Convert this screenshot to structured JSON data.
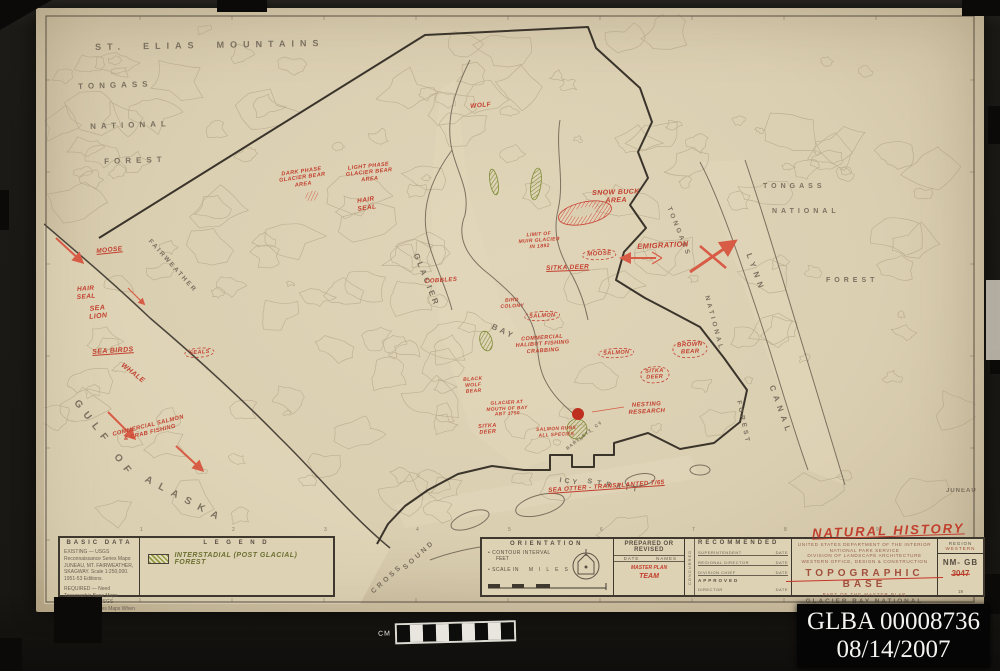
{
  "archive_label": {
    "line1": "GLBA 00008736",
    "line2": "08/14/2007"
  },
  "ruler_label": "CM",
  "natural_history_note": "NATURAL HISTORY",
  "colors": {
    "annotation_red": "#c2402f",
    "forest_green": "#8f9c3e",
    "sheet_beige": "#dbcfb2",
    "ink_brown": "#4a443a"
  },
  "map": {
    "grid_numbers": [
      "1",
      "2",
      "3",
      "4",
      "5",
      "6",
      "7",
      "8",
      "9"
    ],
    "place_labels": [
      {
        "t": "ST.  ELIAS  MOUNTAINS",
        "x": 95,
        "y": 42,
        "s": 9,
        "ls": 6,
        "r": -1
      },
      {
        "t": "TONGASS",
        "x": 78,
        "y": 82,
        "s": 8,
        "ls": 5,
        "r": -2
      },
      {
        "t": "NATIONAL",
        "x": 90,
        "y": 122,
        "s": 8,
        "ls": 5,
        "r": -2
      },
      {
        "t": "FOREST",
        "x": 104,
        "y": 157,
        "s": 8,
        "ls": 5,
        "r": -2
      },
      {
        "t": "FAIRWEATHER",
        "x": 152,
        "y": 238,
        "s": 6.5,
        "ls": 2,
        "r": 48
      },
      {
        "t": "GLACIER",
        "x": 420,
        "y": 252,
        "s": 8,
        "ls": 3,
        "r": 68
      },
      {
        "t": "BAY",
        "x": 494,
        "y": 322,
        "s": 8,
        "ls": 3,
        "r": 25
      },
      {
        "t": "GULF",
        "x": 80,
        "y": 398,
        "s": 10,
        "ls": 7,
        "r": 52
      },
      {
        "t": "OF",
        "x": 120,
        "y": 452,
        "s": 10,
        "ls": 7,
        "r": 52
      },
      {
        "t": "ALASKA",
        "x": 148,
        "y": 474,
        "s": 10,
        "ls": 8,
        "r": 28
      },
      {
        "t": "ICY",
        "x": 560,
        "y": 477,
        "s": 7,
        "ls": 3,
        "r": 8
      },
      {
        "t": "STRAIT",
        "x": 588,
        "y": 478,
        "s": 7,
        "ls": 5,
        "r": 10
      },
      {
        "t": "CROSS",
        "x": 370,
        "y": 590,
        "s": 7,
        "ls": 3,
        "r": -42
      },
      {
        "t": "SOUND",
        "x": 402,
        "y": 566,
        "s": 7,
        "ls": 3,
        "r": -42
      },
      {
        "t": "LYNN",
        "x": 753,
        "y": 252,
        "s": 8,
        "ls": 5,
        "r": 70
      },
      {
        "t": "CANAL",
        "x": 776,
        "y": 384,
        "s": 8,
        "ls": 5,
        "r": 70
      },
      {
        "t": "TONGASS",
        "x": 763,
        "y": 183,
        "s": 7,
        "ls": 4,
        "r": 0
      },
      {
        "t": "NATIONAL",
        "x": 772,
        "y": 208,
        "s": 7,
        "ls": 4,
        "r": 0
      },
      {
        "t": "FOREST",
        "x": 826,
        "y": 277,
        "s": 7,
        "ls": 4,
        "r": 0
      },
      {
        "t": "TONGASS",
        "x": 672,
        "y": 206,
        "s": 6.5,
        "ls": 3,
        "r": 68
      },
      {
        "t": "NATIONAL",
        "x": 710,
        "y": 295,
        "s": 6.5,
        "ls": 3,
        "r": 75
      },
      {
        "t": "FOREST",
        "x": 742,
        "y": 400,
        "s": 6.5,
        "ls": 3,
        "r": 78
      },
      {
        "t": "JUNEAU",
        "x": 946,
        "y": 488,
        "s": 6,
        "ls": 1,
        "r": 0
      },
      {
        "t": "BARTLETT  CV",
        "x": 565,
        "y": 447,
        "s": 4.5,
        "ls": 1,
        "r": -38
      }
    ],
    "annotations": [
      {
        "t": "WOLF",
        "x": 470,
        "y": 103,
        "s": 6.5,
        "r": -5
      },
      {
        "t": "DARK PHASE\nGLACIER BEAR\nAREA",
        "x": 278,
        "y": 172,
        "s": 5.5,
        "r": -8
      },
      {
        "t": "LIGHT PHASE\nGLACIER BEAR\nAREA",
        "x": 345,
        "y": 166,
        "s": 5.5,
        "r": -6
      },
      {
        "t": "HAIR\nSEAL",
        "x": 356,
        "y": 198,
        "s": 6.5,
        "r": -8
      },
      {
        "t": "SNOW BUCK\nAREA",
        "x": 592,
        "y": 190,
        "s": 7,
        "r": -2
      },
      {
        "t": "LIMIT OF\nMUIR GLACIER\nIN 1892",
        "x": 518,
        "y": 234,
        "s": 5,
        "r": -4
      },
      {
        "t": "MOOSE",
        "x": 582,
        "y": 250,
        "s": 6,
        "r": -3,
        "cls": "cloud"
      },
      {
        "t": "SITKA DEER",
        "x": 546,
        "y": 265,
        "s": 6.5,
        "r": -2,
        "cls": "ul"
      },
      {
        "t": "EMIGRATION",
        "x": 637,
        "y": 243,
        "s": 7.5,
        "r": -3
      },
      {
        "t": "MOOSE",
        "x": 96,
        "y": 248,
        "s": 6.5,
        "r": -6,
        "cls": "ul"
      },
      {
        "t": "HAIR\nSEAL",
        "x": 76,
        "y": 286,
        "s": 6.5,
        "r": -4
      },
      {
        "t": "SEA\nLION",
        "x": 88,
        "y": 306,
        "s": 7,
        "r": -6
      },
      {
        "t": "SEA BIRDS",
        "x": 92,
        "y": 349,
        "s": 7,
        "r": -4,
        "cls": "ul"
      },
      {
        "t": "WHALE",
        "x": 124,
        "y": 362,
        "s": 7,
        "r": 38
      },
      {
        "t": "SEALS",
        "x": 184,
        "y": 349,
        "s": 5.5,
        "r": -5,
        "cls": "cloud"
      },
      {
        "t": "COBBLES",
        "x": 425,
        "y": 279,
        "s": 6,
        "r": -4
      },
      {
        "t": "BIRD\nCOLONY",
        "x": 500,
        "y": 299,
        "s": 5,
        "r": -3
      },
      {
        "t": "SALMON",
        "x": 524,
        "y": 312,
        "s": 5.5,
        "r": -3,
        "cls": "cloud"
      },
      {
        "t": "COMMERCIAL\nHALIBUT FISHING\nCRABBING",
        "x": 515,
        "y": 337,
        "s": 5.5,
        "r": -4
      },
      {
        "t": "SALMON",
        "x": 598,
        "y": 349,
        "s": 5.5,
        "r": -3,
        "cls": "cloud"
      },
      {
        "t": "SITKA\nDEER",
        "x": 640,
        "y": 367,
        "s": 5.5,
        "r": -3,
        "cls": "cloud"
      },
      {
        "t": "BROWN\nBEAR",
        "x": 672,
        "y": 341,
        "s": 6,
        "r": -3,
        "cls": "cloud"
      },
      {
        "t": "BLACK\nWOLF\nBEAR",
        "x": 463,
        "y": 378,
        "s": 5,
        "r": -4
      },
      {
        "t": "GLACIER AT\nMOUTH OF BAY\nABT 1750",
        "x": 486,
        "y": 402,
        "s": 4.8,
        "r": -3
      },
      {
        "t": "SITKA\nDEER",
        "x": 478,
        "y": 424,
        "s": 5.5,
        "r": -4
      },
      {
        "t": "SALMON RUNS\nALL SPECIES",
        "x": 536,
        "y": 428,
        "s": 4.8,
        "r": -3
      },
      {
        "t": "NESTING\nRESEARCH",
        "x": 628,
        "y": 403,
        "s": 6,
        "r": -3
      },
      {
        "t": "COMMERCIAL SALMON\n& CRAB FISHING",
        "x": 112,
        "y": 432,
        "s": 5.8,
        "r": -14
      },
      {
        "t": "SEA OTTER - TRANSPLANTED 7/65",
        "x": 548,
        "y": 487,
        "s": 6.2,
        "r": -4,
        "cls": "ul"
      }
    ],
    "panels": {
      "basic_data": {
        "header": "BASIC DATA",
        "existing": "EXISTING — USGS Reconnaissance Series Maps: JUNEAU, MT. FAIRWEATHER, SKAGWAY. Scale 1:250,000. 1951-53 Editions.",
        "required": "REQUIRED — Need Topographic Base Maps Prepared From USGS Topographic Series Maps When Available."
      },
      "legend": {
        "header": "L E G E N D",
        "item": "INTERSTADIAL (POST GLACIAL) FOREST"
      },
      "orientation": {
        "header": "ORIENTATION",
        "contour_label": "CONTOUR INTERVAL",
        "contour_unit": "FEET",
        "scale_label": "SCALE IN",
        "scale_unit": "MILES"
      },
      "prepared": {
        "header": "PREPARED OR REVISED",
        "col_date": "DATE",
        "col_names": "NAMES",
        "note_line1": "MASTER PLAN",
        "note_line2": "TEAM"
      },
      "recommended": {
        "header": "RECOMMENDED",
        "side": "CONCURRED",
        "rows": [
          {
            "label": "SUPERINTENDENT",
            "date": "DATE"
          },
          {
            "label": "REGIONAL DIRECTOR",
            "date": "DATE"
          },
          {
            "label": "DIVISION CHIEF",
            "date": "DATE"
          }
        ],
        "approved": "APPROVED",
        "approved_role": "DIRECTOR",
        "approved_date": "DATE"
      },
      "title_block": {
        "line1": "UNITED STATES DEPARTMENT OF THE INTERIOR",
        "line2": "NATIONAL PARK SERVICE",
        "line3": "DIVISION OF LANDSCAPE ARCHITECTURE",
        "line4": "WESTERN OFFICE, DESIGN & CONSTRUCTION",
        "title": "TOPOGRAPHIC   BASE",
        "sub": "PART OF THE MASTER PLAN",
        "monument": "GLACIER  BAY  NATIONAL  MONUMENT",
        "state": "ALASKA",
        "region_label": "REGION",
        "region_value": "WESTERN",
        "code": "NM- GB",
        "number": "3047",
        "sheet": "19"
      }
    }
  }
}
